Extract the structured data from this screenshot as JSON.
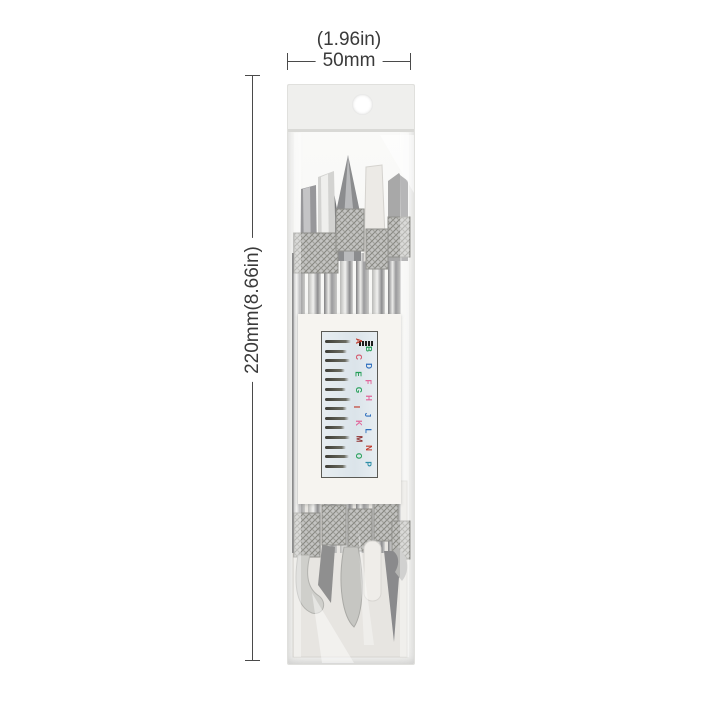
{
  "scene": {
    "background_color": "#ffffff",
    "subject": "double-ended metal carving chisel set in clear hanging bag"
  },
  "dimensions": {
    "width_label_in": "(1.96in)",
    "width_label_mm": "50mm",
    "height_label": "220mm(8.66in)"
  },
  "package": {
    "bag": "clear poly hanging bag",
    "hang_hole": "round hang hole",
    "guide_card": {
      "tip_row_count": 14,
      "letters": [
        {
          "char": "A",
          "color": "#c0392b"
        },
        {
          "char": "B",
          "color": "#27a05a"
        },
        {
          "char": "C",
          "color": "#d4566a"
        },
        {
          "char": "D",
          "color": "#2e6fbe"
        },
        {
          "char": "E",
          "color": "#27a05a"
        },
        {
          "char": "F",
          "color": "#e0679b"
        },
        {
          "char": "G",
          "color": "#27a05a"
        },
        {
          "char": "H",
          "color": "#e0679b"
        },
        {
          "char": "I",
          "color": "#c0392b"
        },
        {
          "char": "J",
          "color": "#2e6fbe"
        },
        {
          "char": "K",
          "color": "#e0679b"
        },
        {
          "char": "L",
          "color": "#2e6fbe"
        },
        {
          "char": "M",
          "color": "#8e2f2f"
        },
        {
          "char": "N",
          "color": "#c0392b"
        },
        {
          "char": "O",
          "color": "#27a05a"
        },
        {
          "char": "P",
          "color": "#2e8fa8"
        }
      ]
    }
  },
  "colors": {
    "dimension_line": "#4a4a4a",
    "dimension_text": "#3a3a3a",
    "bag_flap": "#efefed",
    "metal_dark": "#8f8f91",
    "metal_light": "#d6d6d4",
    "card": "#f6f4f0"
  }
}
